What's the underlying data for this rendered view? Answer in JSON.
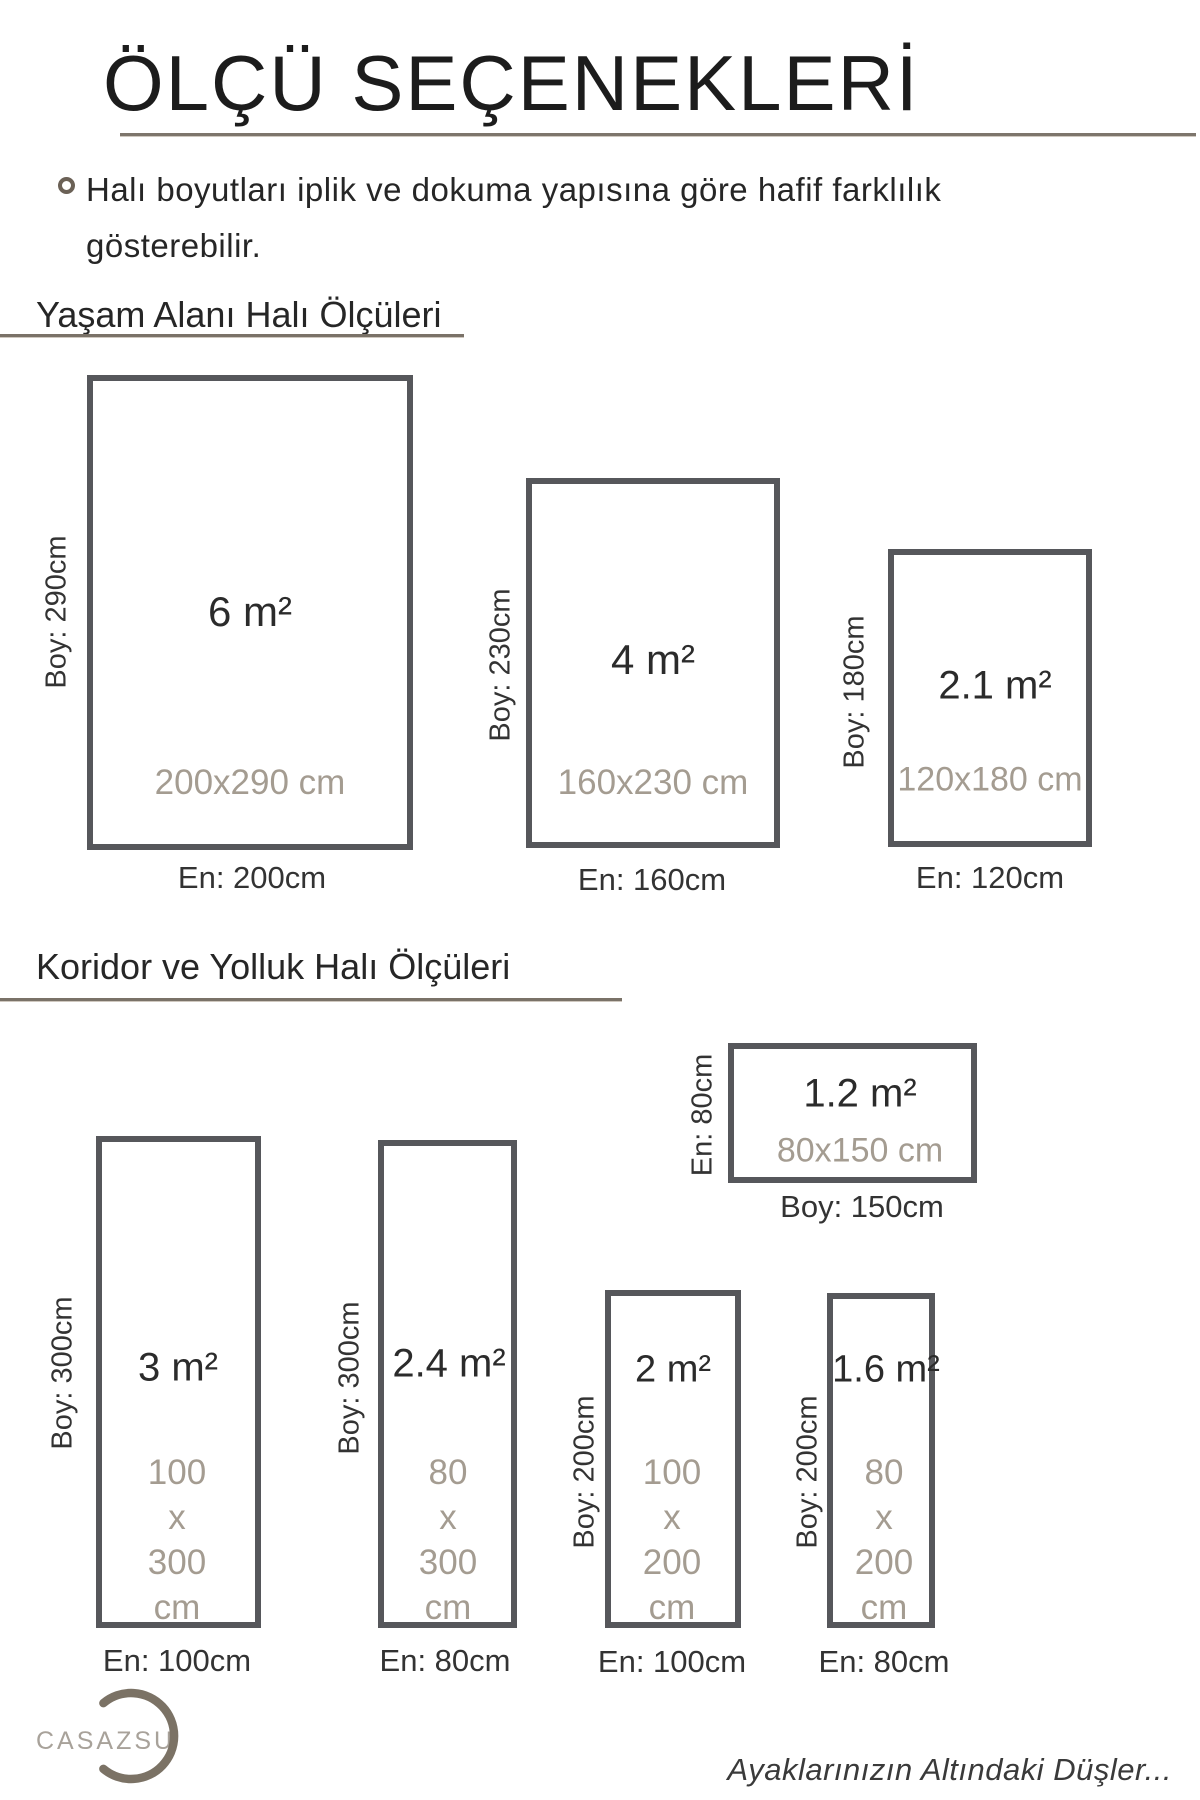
{
  "header": {
    "title": "ÖLÇÜ SEÇENEKLERİ",
    "note_line1": "Halı boyutları iplik ve dokuma yapısına göre hafif farklılık",
    "note_line2": "gösterebilir."
  },
  "sections": {
    "living": {
      "heading": "Yaşam Alanı Halı Ölçüleri"
    },
    "runner": {
      "heading": "Koridor ve Yolluk Halı Ölçüleri"
    }
  },
  "rugs": {
    "r6": {
      "area": "6 m²",
      "dims": "200x290 cm",
      "boy": "Boy: 290cm",
      "en": "En: 200cm"
    },
    "r4": {
      "area": "4 m²",
      "dims": "160x230 cm",
      "boy": "Boy: 230cm",
      "en": "En: 160cm"
    },
    "r21": {
      "area": "2.1 m²",
      "dims": "120x180 cm",
      "boy": "Boy: 180cm",
      "en": "En: 120cm"
    },
    "r12": {
      "area": "1.2 m²",
      "dims": "80x150 cm",
      "en_side": "En: 80cm",
      "boy_bottom": "Boy: 150cm"
    },
    "r3": {
      "area": "3 m²",
      "dims_stacked": "100\nx\n300\ncm",
      "boy": "Boy: 300cm",
      "en": "En: 100cm"
    },
    "r24": {
      "area": "2.4 m²",
      "dims_stacked": "80\nx\n300\ncm",
      "boy": "Boy: 300cm",
      "en": "En: 80cm"
    },
    "r2": {
      "area": "2 m²",
      "dims_stacked": "100\nx\n200\ncm",
      "boy": "Boy: 200cm",
      "en": "En: 100cm"
    },
    "r16": {
      "area": "1.6 m²",
      "dims_stacked": "80\nx\n200\ncm",
      "boy": "Boy: 200cm",
      "en": "En: 80cm"
    }
  },
  "footer": {
    "brand": "CASAZSU",
    "slogan": "Ayaklarınızın Altındaki Düşler..."
  },
  "colors": {
    "rug_border": "#56575b",
    "dim_text": "#a49c91",
    "rule_line": "#7a7268",
    "logo_arc": "#7b7265",
    "logo_text": "#a8a29a"
  }
}
